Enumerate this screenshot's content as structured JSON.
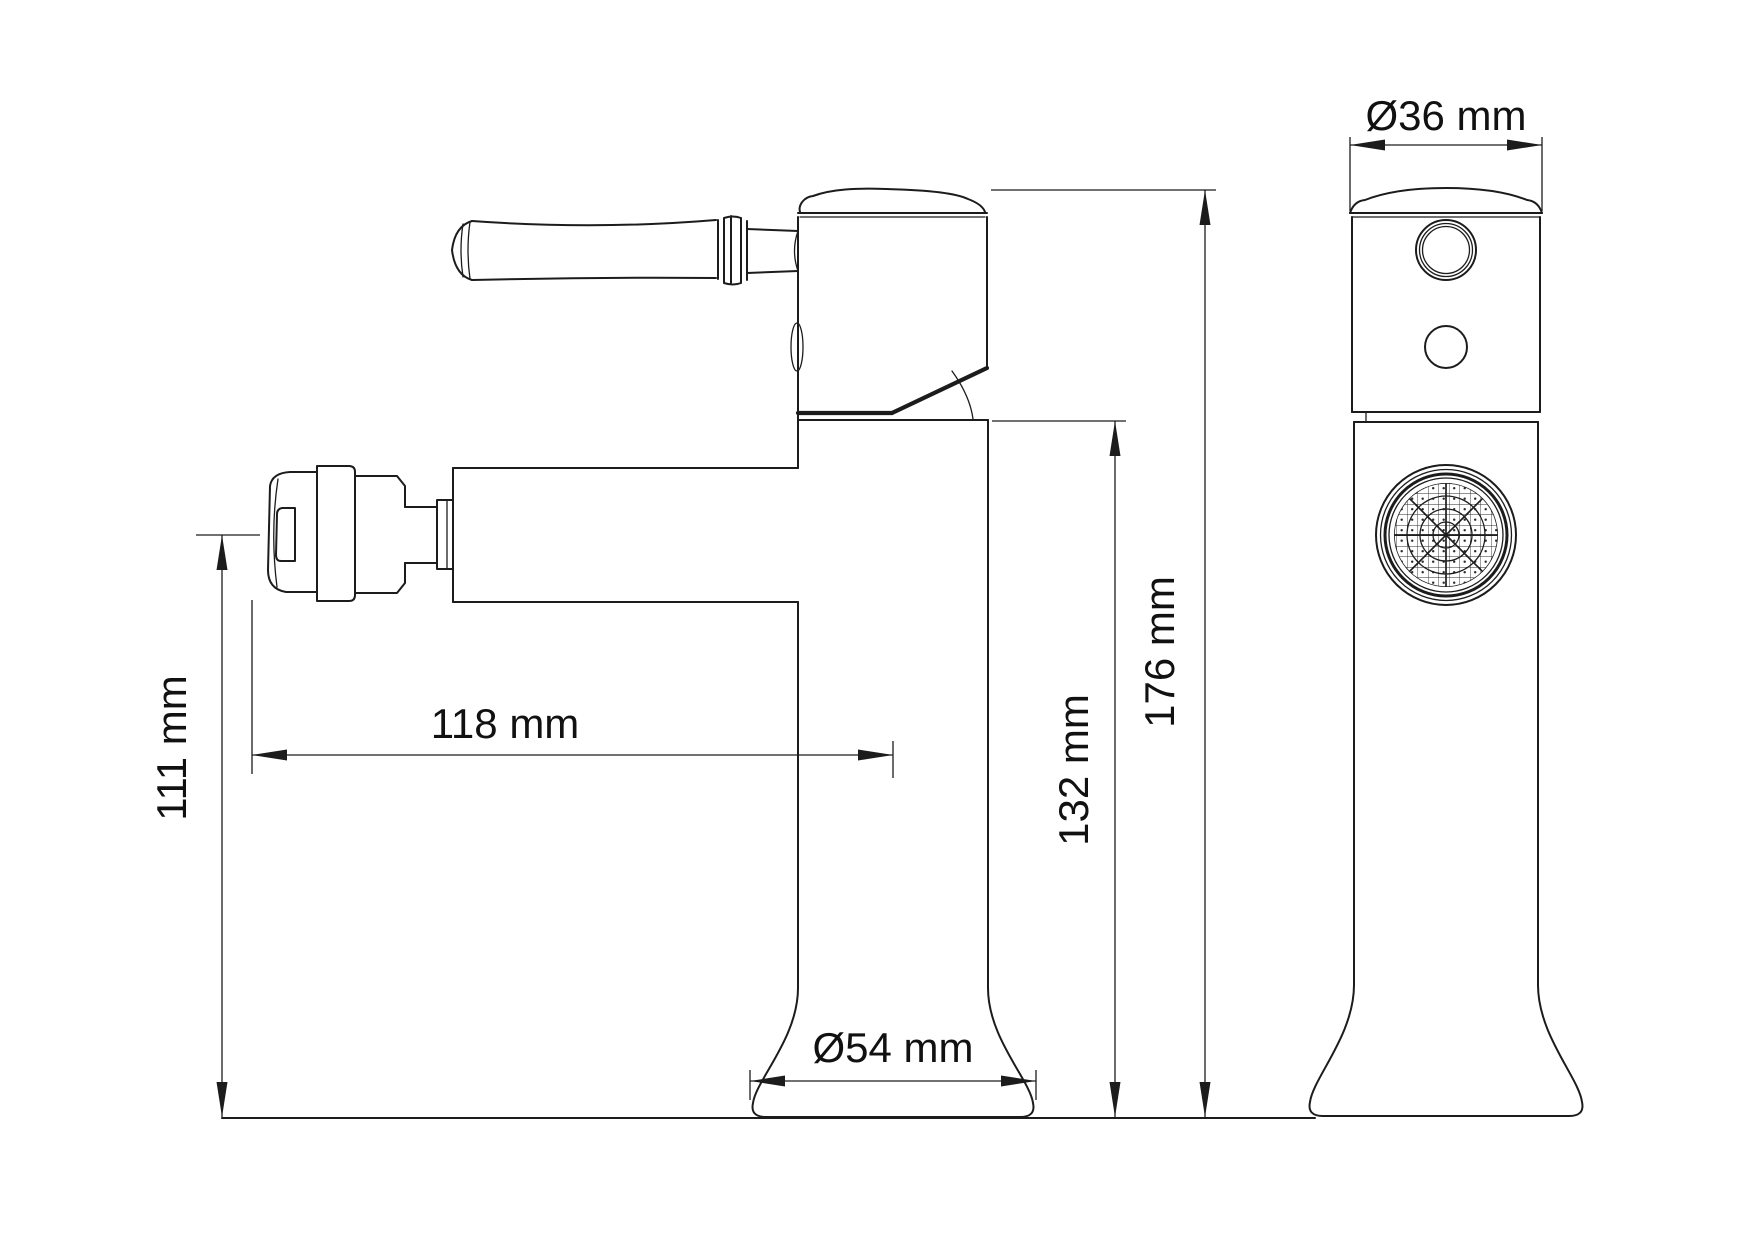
{
  "drawing": {
    "labels": {
      "front_width": "Ø36 mm",
      "base_diameter": "Ø54 mm",
      "spout_height": "111 mm",
      "spout_reach": "118 mm",
      "body_height": "132 mm",
      "total_height": "176 mm"
    },
    "colors": {
      "line": "#1c1c1c",
      "background": "#ffffff"
    }
  }
}
